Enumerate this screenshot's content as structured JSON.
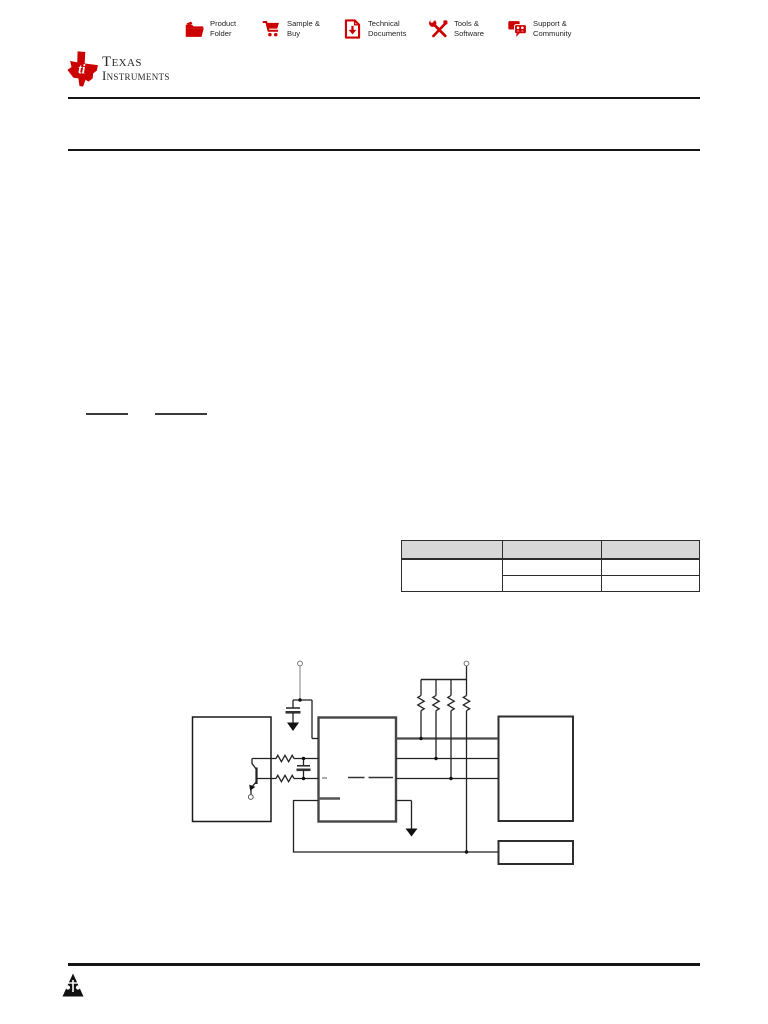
{
  "toolbar": {
    "actions": [
      {
        "label": "Product Folder",
        "icon": "folder-icon"
      },
      {
        "label": "Sample & Buy",
        "icon": "cart-icon"
      },
      {
        "label": "Technical Documents",
        "icon": "document-download-icon"
      },
      {
        "label": "Tools & Software",
        "icon": "tools-icon"
      },
      {
        "label": "Support & Community",
        "icon": "community-icon"
      }
    ]
  },
  "brand": {
    "line1": "Texas",
    "line2": "Instruments"
  },
  "table": {
    "header": [
      "",
      "",
      ""
    ],
    "rows": [
      [
        "",
        "",
        ""
      ],
      [
        "",
        ""
      ]
    ]
  },
  "colors": {
    "ti_red": "#cc0000",
    "table_header_bg": "#d8d8d8",
    "rule": "#161616",
    "wire": "#222222",
    "box_border": "#3d3d3d"
  },
  "diagram": {
    "components": [
      "source-block",
      "npn-transistor",
      "series-resistors",
      "decoupling-capacitor",
      "filter-capacitor",
      "controller-block",
      "pullup-resistors",
      "host-block",
      "aux-block",
      "supply-terminal-left",
      "supply-terminal-right",
      "emitter-terminal",
      "ground-symbol-left",
      "ground-symbol-right",
      "feedback-loop"
    ]
  }
}
